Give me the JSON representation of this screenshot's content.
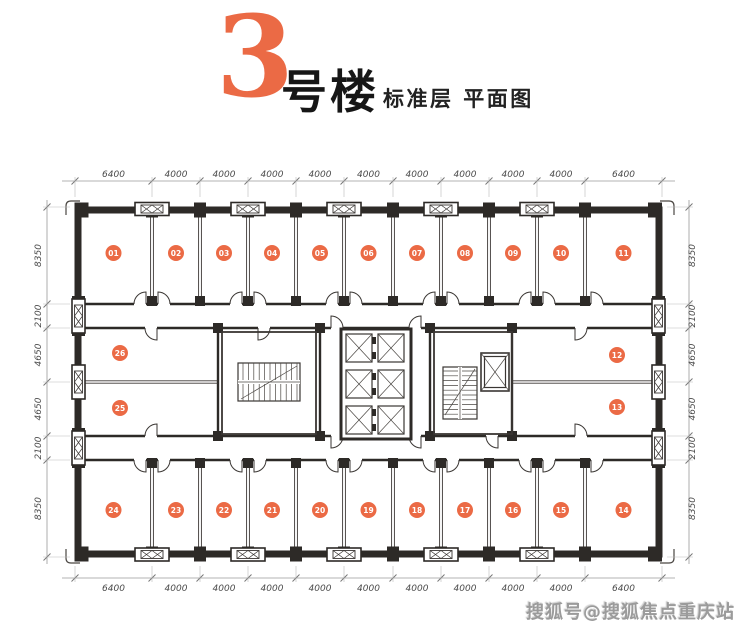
{
  "title": {
    "building_number": "3",
    "building_suffix": "号楼",
    "subtitle": "标准层 平面图"
  },
  "watermark": "搜狐号@搜狐焦点重庆站",
  "colors": {
    "accent": "#EB6A45",
    "wall": "#2D2A27",
    "line": "#3A3633",
    "dimension_text": "#4A4A4A",
    "watermark_text": "#9B9B9B"
  },
  "dimensions": {
    "top": [
      "6400",
      "4000",
      "4000",
      "4000",
      "4000",
      "4000",
      "4000",
      "4000",
      "4000",
      "4000",
      "6400"
    ],
    "bottom": [
      "6400",
      "4000",
      "4000",
      "4000",
      "4000",
      "4000",
      "4000",
      "4000",
      "4000",
      "4000",
      "6400"
    ],
    "left": [
      "8350",
      "2100",
      "4650",
      "4650",
      "2100",
      "8350"
    ],
    "right": [
      "8350",
      "2100",
      "4650",
      "4650",
      "2100",
      "8350"
    ]
  },
  "rooms": {
    "top_row": [
      "01",
      "02",
      "03",
      "04",
      "05",
      "06",
      "07",
      "08",
      "09",
      "10",
      "11"
    ],
    "middle_left": [
      "26",
      "25"
    ],
    "middle_right": [
      "12",
      "13"
    ],
    "bottom_row": [
      "24",
      "23",
      "22",
      "21",
      "20",
      "19",
      "18",
      "17",
      "16",
      "15",
      "14"
    ]
  }
}
